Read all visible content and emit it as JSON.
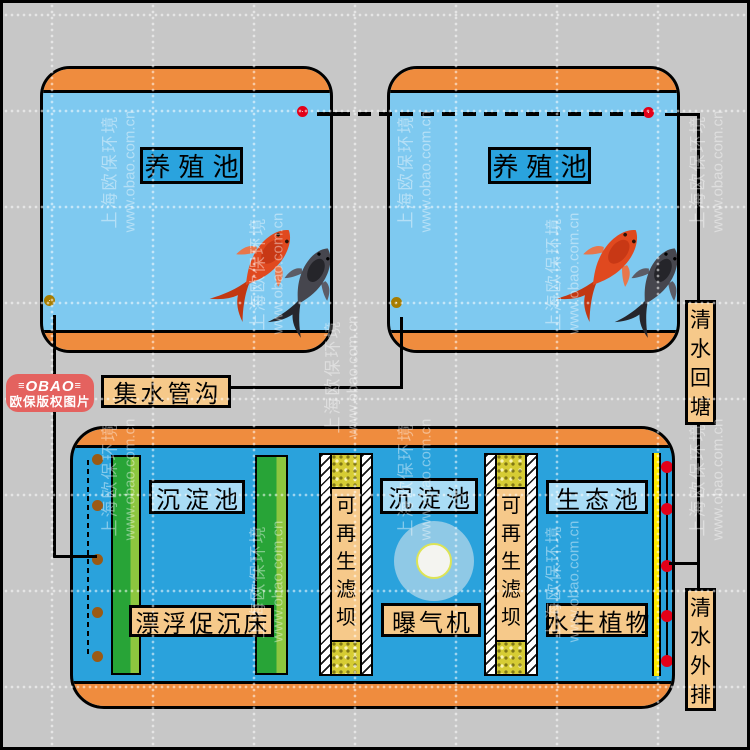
{
  "watermark": {
    "line1": "上海欧保环境",
    "line2": "www.obao.com.cn"
  },
  "logo": {
    "flank_left": "≡",
    "brand": "OBAO",
    "flank_right": "≡",
    "caption": "欧保版权图片"
  },
  "ponds": {
    "pond1_label": "养殖池",
    "pond2_label": "养殖池"
  },
  "pipes": {
    "collector": "集水管沟",
    "return_to_pond": "清水回塘",
    "discharge": "清水外排"
  },
  "treatment": {
    "sedimentation1": "沉淀池",
    "floating_bed": "漂浮促沉床",
    "filter_dam1": "可再生滤坝",
    "sedimentation2": "沉淀池",
    "aerator": "曝气机",
    "filter_dam2": "可再生滤坝",
    "ecological_pond": "生态池",
    "aquatic_plants": "水生植物"
  },
  "colors": {
    "background": "#C7C7C7",
    "pond_water": "#7EC9F0",
    "treatment_water": "#2AA2DC",
    "rim_orange": "#EF8C3E",
    "label_dark_blue": "#2AA3DE",
    "label_light_blue": "#A9DCF5",
    "label_tan": "#F6C98A",
    "outlet_red": "#E30018",
    "drain_olive": "#A67C00",
    "dot_brown": "#9B5A14",
    "bed_green_dark": "#28A437",
    "bed_green_light": "#8DC63F",
    "media_yellow": "#D6CC34",
    "stripe_yellow": "#FFE800",
    "logo_red": "#E4625F"
  }
}
